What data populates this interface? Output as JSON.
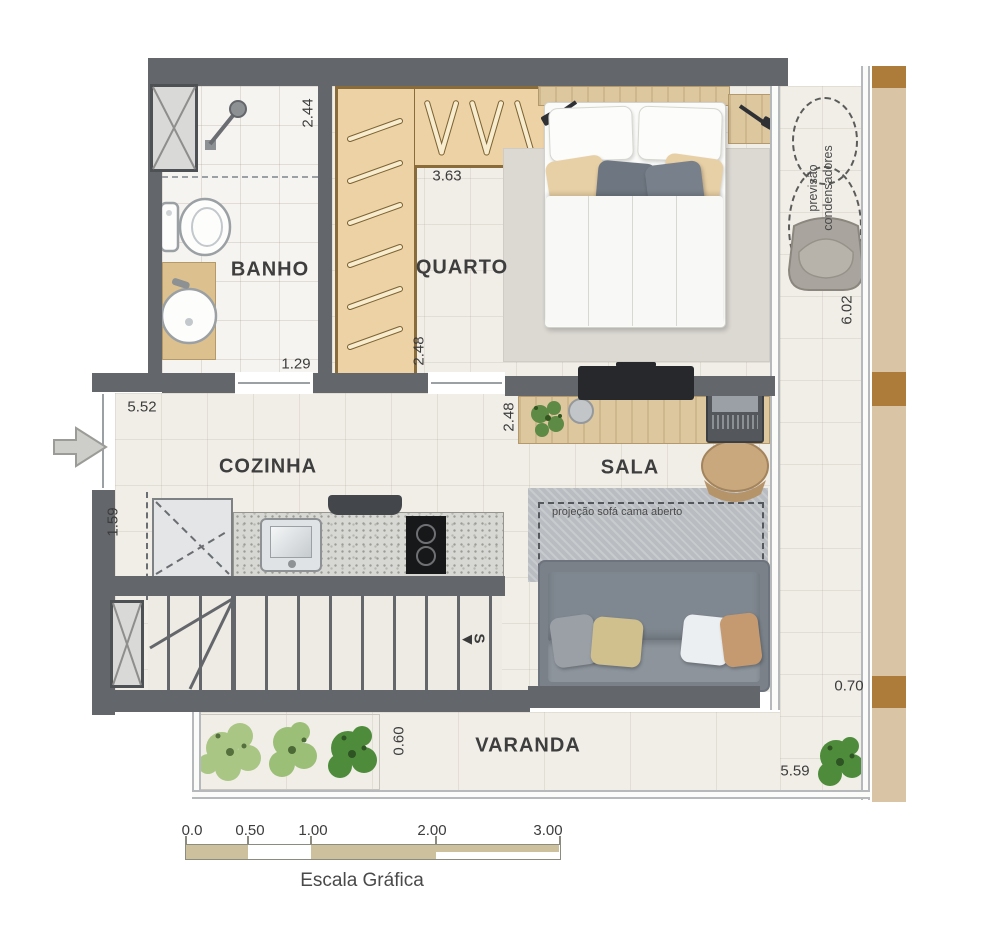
{
  "rooms": {
    "banho": "BANHO",
    "quarto": "QUARTO",
    "cozinha": "COZINHA",
    "sala": "SALA",
    "varanda": "VARANDA"
  },
  "dimensions": {
    "banho_depth": "2.44",
    "closet_front": "3.63",
    "banho_door": "1.29",
    "quarto_opening": "2.48",
    "sala_opening": "2.48",
    "cozinha_length": "5.52",
    "cozinha_depth": "1.59",
    "side_terrace_length": "6.02",
    "side_terrace_width": "0.70",
    "varanda_depth": "0.60",
    "varanda_length": "5.59"
  },
  "notes": {
    "condensers_line1": "previsão",
    "condensers_line2": "condensadores",
    "sofa_projection": "projeção sofá cama aberto",
    "stairs_letter": "S"
  },
  "scale_bar": {
    "title": "Escala Gráfica",
    "ticks": [
      "0.0",
      "0.50",
      "1.00",
      "2.00",
      "3.00"
    ]
  },
  "colors": {
    "wall": "#63666a",
    "closet_wood": "#ecd2a4",
    "deck_wood": "#d9c5a6",
    "deck_accent": "#ad7c3b",
    "floor": "#f1eee8",
    "rug": "#dcd9d3",
    "sofa": "#7a8189",
    "scale_tan": "#cdc09c"
  }
}
